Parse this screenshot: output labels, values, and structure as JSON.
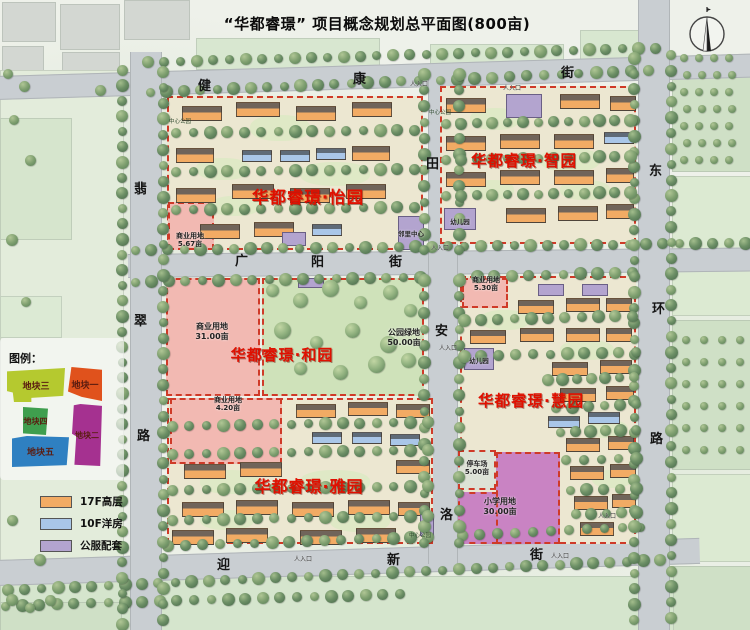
{
  "title": "“华都睿璟” 项目概念规划总平面图(800亩)",
  "colors": {
    "project_name": "#e01000",
    "parcel_border": "#cf3a28",
    "road": "#c9ced2"
  },
  "streets": {
    "jiankang": {
      "chars": [
        "健",
        "康",
        "街"
      ]
    },
    "guangyang": {
      "chars": [
        "广",
        "阳",
        "街"
      ]
    },
    "yingxin": {
      "chars": [
        "迎",
        "新",
        "街"
      ]
    },
    "feicui": {
      "chars": [
        "翡",
        "翠",
        "路"
      ]
    },
    "donghuan": {
      "chars": [
        "东",
        "环",
        "路"
      ]
    },
    "central": {
      "chars": [
        "田",
        "安",
        "洛"
      ]
    }
  },
  "projects": {
    "yiyuan": "华都睿璟·怡园",
    "zhiyuan": "华都睿璟·智园",
    "heyuan": "华都睿璟·和园",
    "yayuan": "华都睿璟·雅园",
    "huiyuan": "华都睿璟·慧园"
  },
  "parcels": {
    "commercial_nw": {
      "label": "商业用地",
      "area": "5.67亩"
    },
    "commercial_w": {
      "label": "商业用地",
      "area": "31.00亩"
    },
    "park_green": {
      "label": "公园绿地",
      "area": "50.00亩"
    },
    "commercial_e": {
      "label": "商业用地",
      "area": "5.30亩"
    },
    "commercial_sw": {
      "label": "商业用地",
      "area": "4.20亩"
    },
    "parking": {
      "label": "停车场",
      "area": "5.00亩"
    },
    "school": {
      "label": "小学用地",
      "area": "30.00亩"
    }
  },
  "facilities": {
    "neighborhood_center": "邻里中心",
    "kindergarten_n": "幼儿园",
    "kindergarten_s": "幼儿园"
  },
  "labels": {
    "entrance": "人入口",
    "corner_park": "中心公园"
  },
  "legend_plots": {
    "title": "图例：",
    "items": [
      {
        "label": "地块三",
        "color": "#b5c92f"
      },
      {
        "label": "地块一",
        "color": "#e0521c"
      },
      {
        "label": "地块四",
        "color": "#3f9e4e"
      },
      {
        "label": "地块二",
        "color": "#a53190"
      },
      {
        "label": "地块五",
        "color": "#2f80c1"
      }
    ]
  },
  "legend_types": {
    "items": [
      {
        "label": "17F高层",
        "color": "#f2ab64"
      },
      {
        "label": "10F洋房",
        "color": "#a9c6e8"
      },
      {
        "label": "公服配套",
        "color": "#b3a4cf"
      }
    ]
  }
}
